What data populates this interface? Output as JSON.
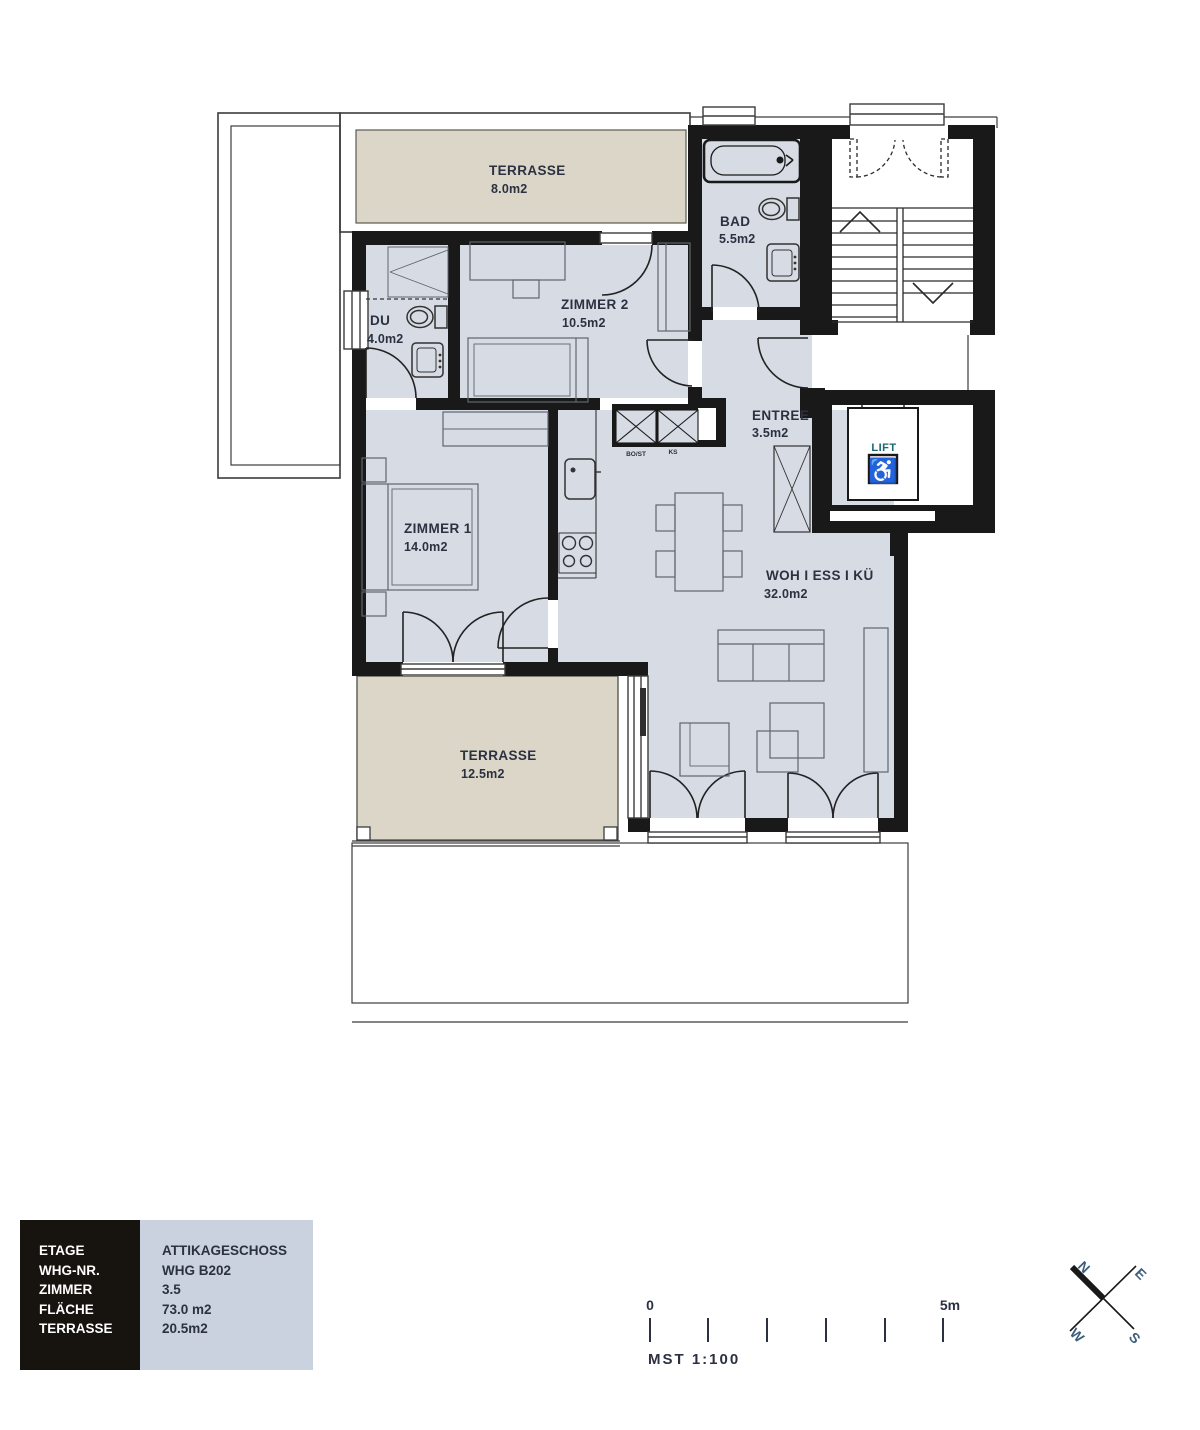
{
  "plan": {
    "rooms": {
      "terrasse_top": {
        "name": "TERRASSE",
        "area": "8.0m2"
      },
      "zimmer2": {
        "name": "ZIMMER 2",
        "area": "10.5m2"
      },
      "du": {
        "name": "DU",
        "area": "4.0m2"
      },
      "bad": {
        "name": "BAD",
        "area": "5.5m2"
      },
      "entree": {
        "name": "ENTREE",
        "area": "3.5m2"
      },
      "lift": {
        "name": "LIFT"
      },
      "zimmer1": {
        "name": "ZIMMER 1",
        "area": "14.0m2"
      },
      "wohnen": {
        "name": "WOH I ESS I KÜ",
        "area": "32.0m2"
      },
      "terrasse_bottom": {
        "name": "TERRASSE",
        "area": "12.5m2"
      }
    },
    "kitchen": {
      "left_label": "BO/ST",
      "right_label": "KS"
    }
  },
  "legend": {
    "rows": [
      {
        "label": "ETAGE",
        "value": "ATTIKAGESCHOSS"
      },
      {
        "label": "WHG-NR.",
        "value": "WHG B202"
      },
      {
        "label": "ZIMMER",
        "value": "3.5"
      },
      {
        "label": "FLÄCHE",
        "value": "73.0 m2"
      },
      {
        "label": "TERRASSE",
        "value": "20.5m2"
      }
    ]
  },
  "scalebar": {
    "zero": "0",
    "five": "5m",
    "caption": "MST  1:100"
  },
  "compass": {
    "n": "N",
    "e": "E",
    "s": "S",
    "w": "W"
  },
  "colors": {
    "floor": "#d6dbe4",
    "terrace": "#dcd6c9",
    "wall": "#191919",
    "lift_accent": "#17696e",
    "compass_letter": "#3f5f7e",
    "legend_dark": "#17130e",
    "legend_light": "#c9d2de"
  }
}
